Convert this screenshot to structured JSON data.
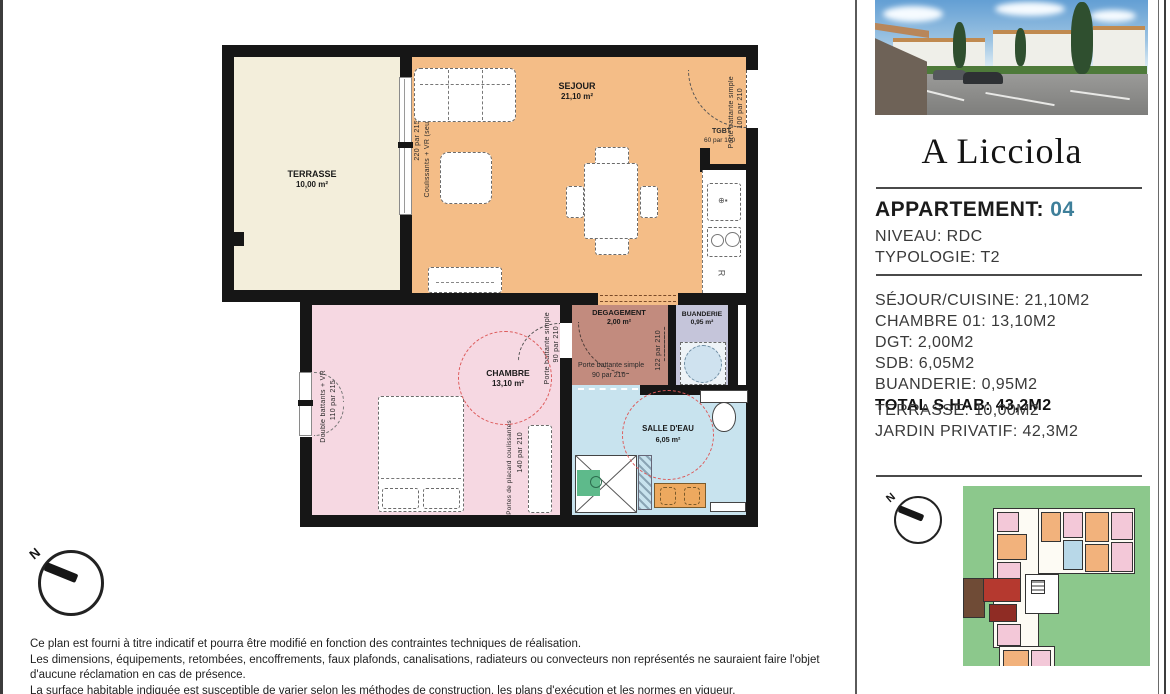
{
  "panel": {
    "logo": "A Licciola",
    "apartment": {
      "label": "APPARTEMENT:",
      "number": "04"
    },
    "niveau": "NIVEAU: RDC",
    "typologie": "TYPOLOGIE: T2",
    "surfaces": [
      "SÉJOUR/CUISINE: 21,10M2",
      "CHAMBRE 01: 13,10M2",
      "DGT: 2,00M2",
      "SDB: 6,05M2",
      "BUANDERIE: 0,95M2"
    ],
    "total": "TOTAL S.HAB: 43,2M2",
    "exterior": [
      "TERRASSE: 10,00M2",
      "JARDIN PRIVATIF: 42,3M2"
    ],
    "compass": "N"
  },
  "plan": {
    "compass": "N",
    "rooms": {
      "terrasse": {
        "name": "TERRASSE",
        "area": "10,00 m²"
      },
      "sejour": {
        "name": "SEJOUR",
        "area": "21,10 m²"
      },
      "chambre": {
        "name": "CHAMBRE",
        "area": "13,10 m²"
      },
      "degagement": {
        "name": "DEGAGEMENT",
        "area": "2,00 m²"
      },
      "buanderie": {
        "name": "BUANDERIE",
        "area": "0,95 m²"
      },
      "salle_deau": {
        "name": "SALLE D'EAU",
        "area": "6,05 m²"
      }
    },
    "annotations": {
      "terrasse_bay_size": "220 par 215",
      "terrasse_bay_type": "Coulissants + VR (seuil",
      "entry_door_type": "Porte battante simple",
      "entry_door_size": "100 par 210",
      "tgbt_label": "TGBT",
      "tgbt_size": "60 par 100",
      "fridge_label": "R",
      "chambre_door_type": "Porte battante simple",
      "chambre_door_size": "90 par 210",
      "chambre_window_type": "Double battants + VR",
      "chambre_window_size": "110 par 215",
      "placard_label": "Portes de placard coulissantes",
      "placard_size": "140 par 210",
      "dgt_door_type": "Porte battante simple",
      "dgt_door_size": "90 par 210",
      "dgt_placard_size": "122 par 210"
    }
  },
  "disclaimer": [
    "Ce plan est fourni à titre indicatif et pourra être modifié en fonction des contraintes techniques de réalisation.",
    "Les dimensions, équipements, retombées, encoffrements, faux plafonds, canalisations, radiateurs ou convecteurs non représentés ne sauraient faire l'objet",
    "d'aucune réclamation en cas de présence.",
    "La surface habitable indiquée est susceptible de varier selon les méthodes de construction, les plans d'exécution et les normes en vigueur.",
    "Une tolérance de surface de 5 % est expressément admise : toute différence dans les cotes ou la surface habitable dans cette limite ne pourra donner lieu à"
  ],
  "colors": {
    "accent_teal": "#3e7f9a",
    "sejour": "#f4bd87",
    "terrasse": "#f3eedb",
    "chambre": "#f6d8e2",
    "degagement": "#c28b7e",
    "buanderie": "#c5c5da",
    "salle_deau": "#c8e3ee",
    "site_green": "#8cc88c",
    "highlight_red": "#b5392f"
  }
}
